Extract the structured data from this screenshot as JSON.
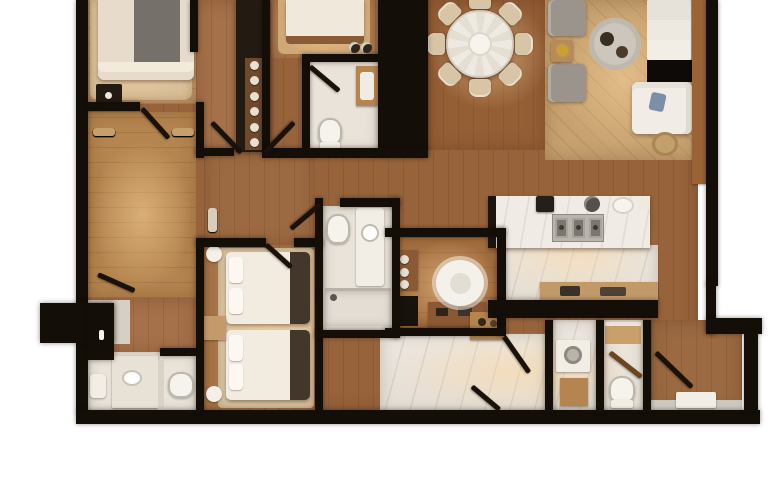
{
  "scene": {
    "type": "photorealistic top-down 3D rendered apartment floor plan",
    "text_visible": false,
    "canvas": {
      "width": 770,
      "height": 483
    },
    "crop_note": "plan is cropped at the top edge of the image; white margins left, right and bottom"
  },
  "palette": {
    "background": "#ffffff",
    "walls": "#140e08",
    "wood_dark": "#8a5a34",
    "wood_mid": "#a5714a",
    "wood_light": "#c9a97e",
    "marble": "#ece7df",
    "rug_beige": "#d9c4a2",
    "bed_linen": "#f0ebe1",
    "sofa_grey": "#9a948c",
    "accent_gold": "#c9a227",
    "cushion_blue": "#7d8fa6"
  },
  "rooms": [
    {
      "id": "master-bedroom",
      "name": "Master bedroom",
      "furniture": [
        "double bed with dark runner",
        "dark nightstand",
        "area rug"
      ]
    },
    {
      "id": "walk-in-closet",
      "name": "Walk-in closet",
      "furniture": [
        "left hanging rail with clothes",
        "right hanging rail with clothes"
      ]
    },
    {
      "id": "dressing-hall",
      "name": "Dressing hall",
      "furniture": [
        "swing door"
      ]
    },
    {
      "id": "master-bathroom",
      "name": "Master bathroom",
      "furniture": [
        "vanity counter",
        "partition",
        "toilet",
        "fixture"
      ]
    },
    {
      "id": "entry",
      "name": "Entry",
      "furniture": [
        "entry door block with handle"
      ]
    },
    {
      "id": "hallway",
      "name": "Central hallway",
      "furniture": [
        "glass display cabinet",
        "double swing doors"
      ]
    },
    {
      "id": "second-bedroom",
      "name": "Second bedroom",
      "furniture": [
        "bed",
        "rug",
        "slippers"
      ]
    },
    {
      "id": "bathroom-2",
      "name": "Bathroom 2",
      "furniture": [
        "toilet",
        "wood-framed vanity",
        "swing door"
      ]
    },
    {
      "id": "wardrobe-corridor",
      "name": "Wardrobe corridor",
      "furniture": [
        "hanging rail with clothes"
      ]
    },
    {
      "id": "twin-bedroom",
      "name": "Twin bedroom",
      "furniture": [
        "twin bed A",
        "twin bed B",
        "shared nightstand",
        "two floor lamps",
        "large beige rug"
      ]
    },
    {
      "id": "bathroom-3",
      "name": "Bathroom 3",
      "furniture": [
        "vanity with sink",
        "toilet",
        "walk-in shower",
        "swing door"
      ]
    },
    {
      "id": "study",
      "name": "Study",
      "furniture": [
        "desk",
        "white fluffy chair",
        "shelving",
        "black cabinet"
      ]
    },
    {
      "id": "dining-area",
      "name": "Dining area",
      "furniture": [
        "round marble dining table",
        "eight beige chairs"
      ]
    },
    {
      "id": "living-area",
      "name": "Living area",
      "furniture": [
        "two grey sofas",
        "side table with gold lamp",
        "round rug",
        "coffee tables",
        "black TV console",
        "white corner sofa",
        "blue cushion",
        "basket",
        "white sideboard"
      ]
    },
    {
      "id": "kitchen",
      "name": "Kitchen",
      "furniture": [
        "marble island with cooktop",
        "espresso machine",
        "kettle",
        "bowl",
        "jar",
        "back counter"
      ]
    },
    {
      "id": "laundry",
      "name": "Laundry",
      "furniture": [
        "washer",
        "cabinet"
      ]
    },
    {
      "id": "bathroom-4",
      "name": "Bathroom 4",
      "furniture": [
        "vanity",
        "toilet",
        "swing door"
      ]
    },
    {
      "id": "terrace",
      "name": "Terrace",
      "furniture": [
        "open glass door",
        "doormat"
      ]
    }
  ]
}
